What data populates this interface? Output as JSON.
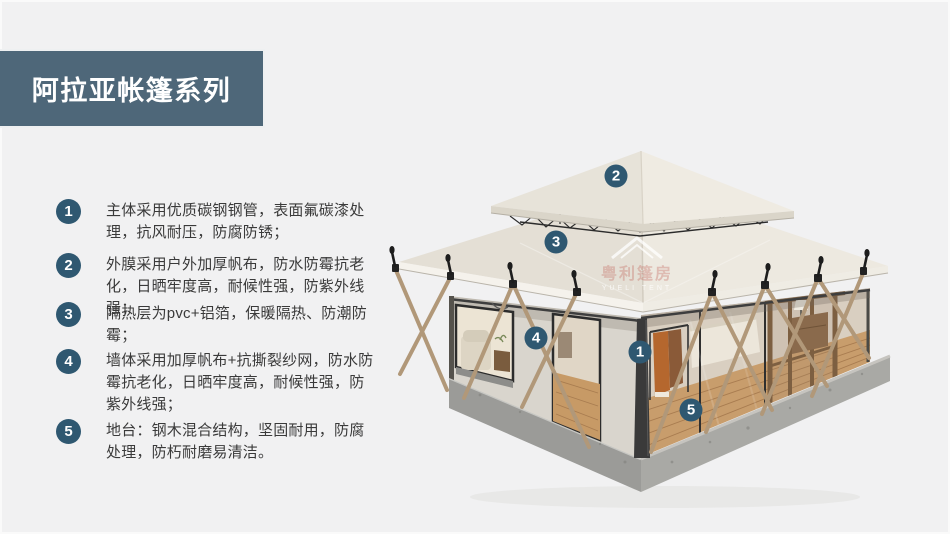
{
  "slide": {
    "background_color": "#f1f1f2",
    "accent_color": "#4e6779",
    "badge_color": "#2f5871",
    "title": {
      "text": "阿拉亚帐篷系列"
    }
  },
  "features": [
    {
      "num": "1",
      "text": "主体采用优质碳钢钢管，表面氟碳漆处理，抗风耐压，防腐防锈；"
    },
    {
      "num": "2",
      "text": "外膜采用户外加厚帆布，防水防霉抗老化，日晒牢度高，耐候性强，防紫外线强；"
    },
    {
      "num": "3",
      "text": "隔热层为pvc+铝箔，保暖隔热、防潮防霉；"
    },
    {
      "num": "4",
      "text": "墙体采用加厚帆布+抗撕裂纱网，防水防霉抗老化，日晒牢度高，耐候性强，防紫外线强；"
    },
    {
      "num": "5",
      "text": "地台：钢木混合结构，坚固耐用，防腐处理，防朽耐磨易清洁。"
    }
  ],
  "tent": {
    "markers": [
      {
        "num": "2",
        "x": 616,
        "y": 176
      },
      {
        "num": "3",
        "x": 556,
        "y": 242
      },
      {
        "num": "4",
        "x": 536,
        "y": 338
      },
      {
        "num": "1",
        "x": 640,
        "y": 352
      },
      {
        "num": "5",
        "x": 691,
        "y": 410
      }
    ],
    "watermark": {
      "cn": "粤利篷房",
      "en": "YUELI TENT"
    }
  }
}
